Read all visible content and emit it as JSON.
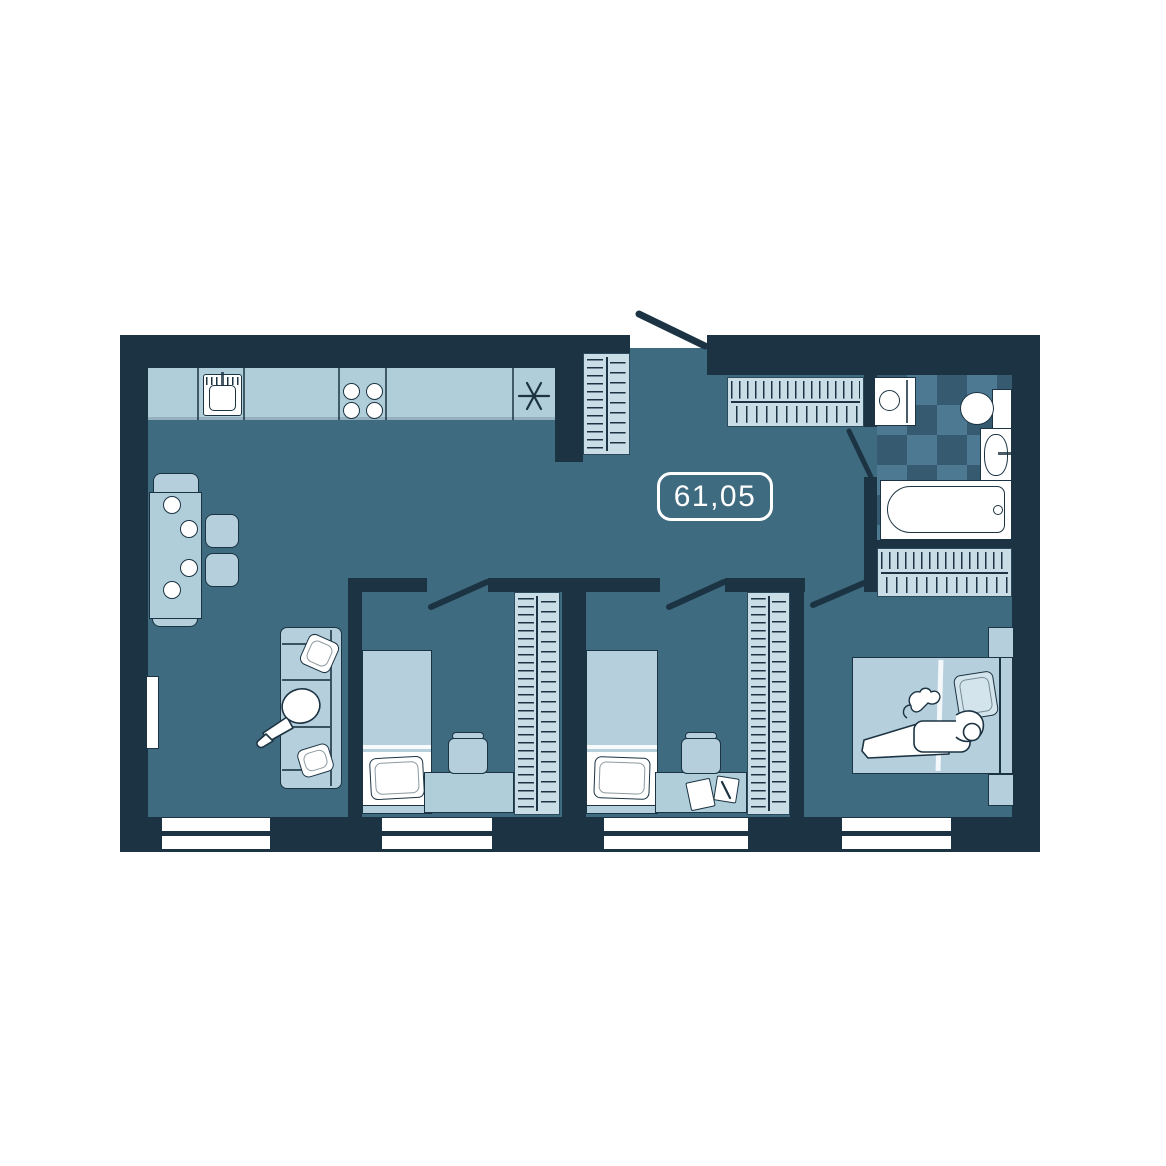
{
  "floor_plan": {
    "area_label": "61,05",
    "colors": {
      "wall": "#1b3342",
      "floor": "#3f6b80",
      "furniture": "#b5cfdd",
      "counter": "#b0cdda",
      "wardrobe": "#c9dde6",
      "tile_light": "#4d7993",
      "tile_dark": "#365b70"
    },
    "rooms": [
      {
        "name": "kitchen-living-room",
        "items": [
          "kitchen-counter",
          "kitchen-sink-icon",
          "stove-burners-icon",
          "refrigerator-asterisk-icon",
          "dining-table",
          "dining-chairs",
          "plates",
          "sofa",
          "sofa-pillows",
          "person-sitting-icon",
          "balcony-door",
          "window"
        ]
      },
      {
        "name": "hallway",
        "items": [
          "entry-door",
          "entry-wardrobe-hatch",
          "hallway-closet-hatch"
        ]
      },
      {
        "name": "bathroom",
        "items": [
          "checkered-tile-floor",
          "washing-machine-icon",
          "toilet-icon",
          "wash-basin-icon",
          "bathtub-icon",
          "bathroom-door"
        ]
      },
      {
        "name": "bedroom-1",
        "items": [
          "single-bed",
          "pillow",
          "desk",
          "desk-chair",
          "wardrobe-hatch",
          "door",
          "window"
        ]
      },
      {
        "name": "bedroom-2",
        "items": [
          "single-bed",
          "pillow",
          "desk",
          "desk-chair",
          "papers",
          "pen",
          "wardrobe-hatch",
          "door",
          "window"
        ]
      },
      {
        "name": "master-bedroom",
        "items": [
          "double-bed",
          "pillow",
          "person-lying-icon",
          "cat-icon",
          "nightstand",
          "nightstand",
          "wardrobe-hatch",
          "door",
          "window"
        ]
      }
    ]
  }
}
